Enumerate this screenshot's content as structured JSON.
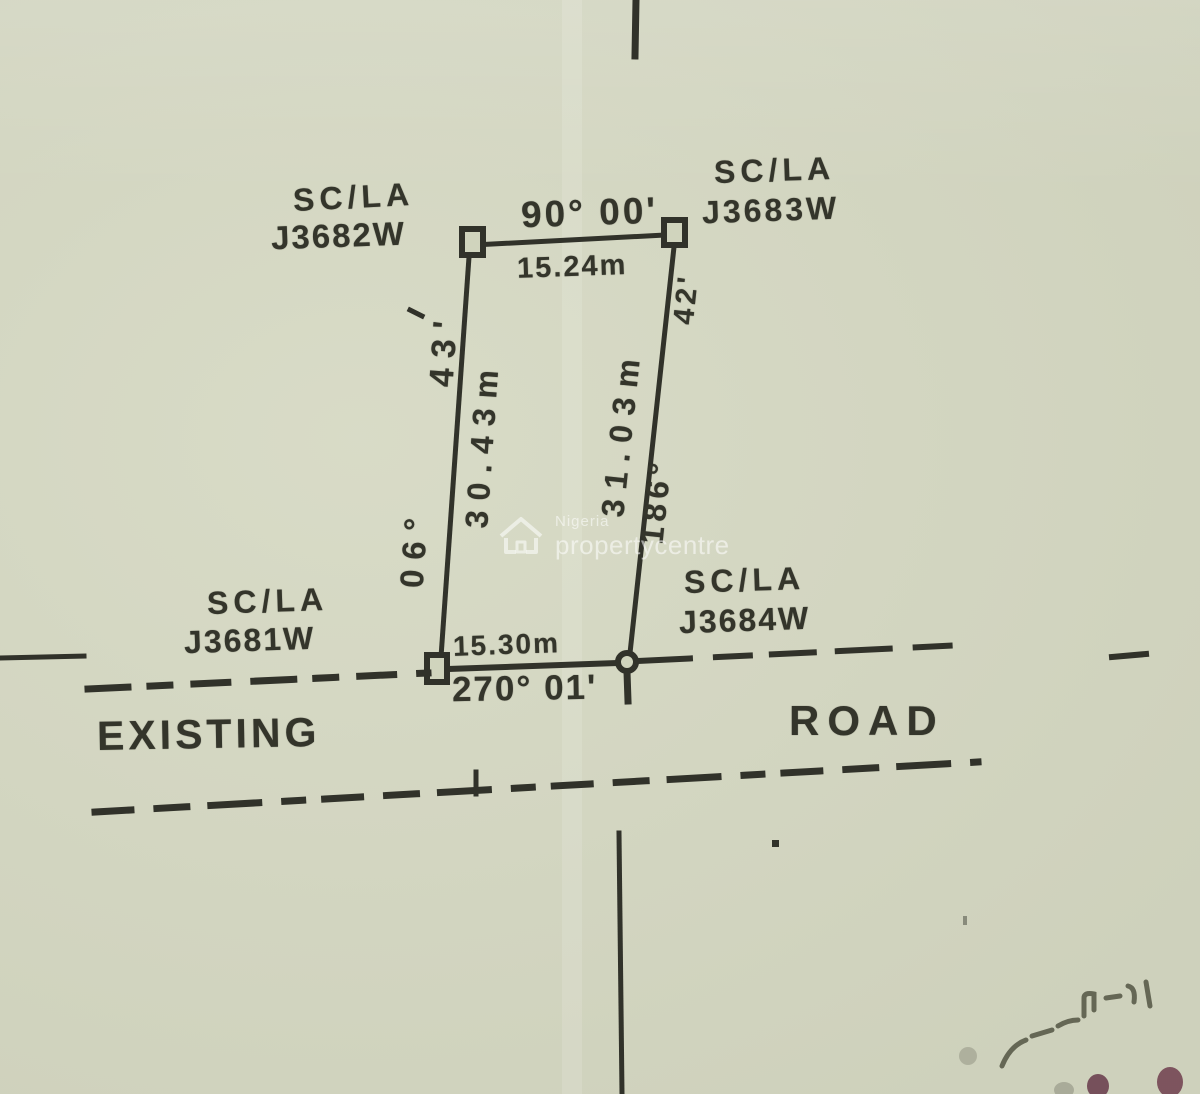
{
  "survey_plan": {
    "beacons": {
      "top_left": {
        "code": "SC/LA",
        "number": "J3682W"
      },
      "top_right": {
        "code": "SC/LA",
        "number": "J3683W"
      },
      "bottom_left": {
        "code": "SC/LA",
        "number": "J3681W"
      },
      "bottom_right": {
        "code": "SC/LA",
        "number": "J3684W"
      }
    },
    "edges": {
      "top": {
        "bearing": "90° 00'",
        "distance": "15.24m"
      },
      "bottom": {
        "bearing": "270° 01'",
        "distance": "15.30m"
      },
      "left": {
        "bearing_deg": "06°",
        "bearing_min": "43'",
        "distance": "30.43m"
      },
      "right": {
        "bearing_deg": "186°",
        "bearing_min": "42'",
        "distance": "31.03m"
      }
    },
    "road": {
      "word_left": "EXISTING",
      "word_right": "ROAD"
    }
  },
  "watermark": {
    "line1": "Nigeria",
    "line2": "propertycentre",
    "icon": "house-icon"
  },
  "colors": {
    "paper": "#d5d8c2",
    "ink": "#31322a",
    "watermark_white": "rgba(255,255,255,0.55)",
    "stamp_maroon": "#6d4150"
  }
}
